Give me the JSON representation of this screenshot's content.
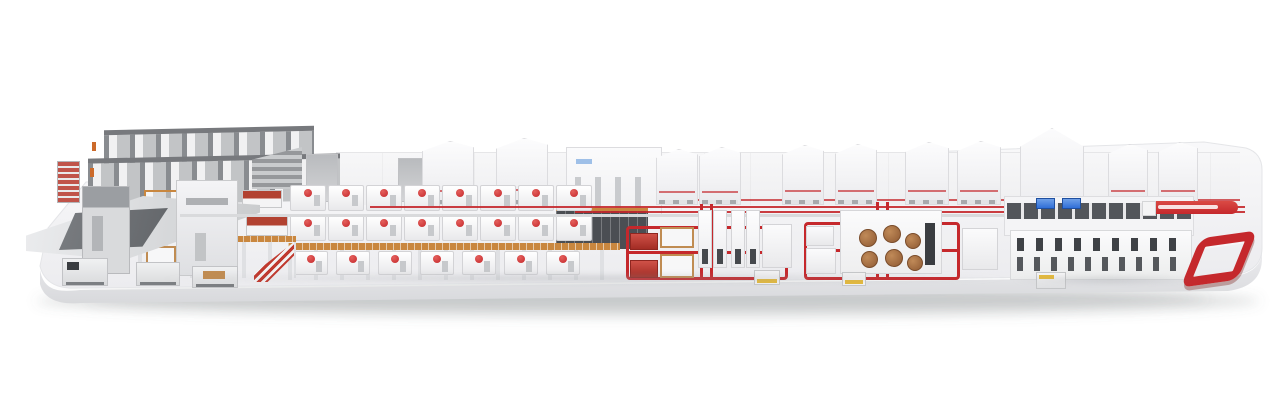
{
  "image": {
    "kind": "3d-render",
    "subject": "Complete corrugated board production line displayed on a long rounded white platform",
    "background": "white, no visible text or UI controls"
  },
  "colors": {
    "background": "#ffffff",
    "platform_top": "#f6f6f8",
    "platform_top_deep": "#ededf0",
    "platform_face": "#e5e6e9",
    "platform_face_deep": "#d6d7da",
    "machine_white": "#f9f9fa",
    "machine_edge": "#d8d9dc",
    "accent_red": "#c5282c",
    "loop_red": "#c5282c",
    "dark_red": "#a33226",
    "charcoal": "#4b4e53",
    "steel_gray": "#9b9ea2",
    "light_gray": "#d9dadc",
    "scaffold_orange": "#c9873f",
    "wood_tan": "#c08c52",
    "roll_brown": "#a06a3e",
    "screen_blue": "#2f6fd8",
    "agv_yellow": "#e3b93d"
  },
  "sections": [
    {
      "name": "roll-storage-racks",
      "description": "stepped gray storage racks with orange markers, far left background"
    },
    {
      "name": "reel-handling-area",
      "description": "flat gray splicing table with dark ramp and AGV carts on the floor"
    },
    {
      "name": "wet-end-mezzanine",
      "description": "orange scaffold mezzanine with brown paper rolls, red-topped splicers and a red-striped staircase"
    },
    {
      "name": "corrugator-bridge",
      "description": "long double-deck row of white machine modules with red motors on slim columns"
    },
    {
      "name": "dry-end-hoods",
      "description": "row of large white hood cabinets with thin red stripes along the back wall"
    },
    {
      "name": "converting-islands",
      "description": "two machine island groups surrounded by red floor conveyor loops"
    },
    {
      "name": "logistics-machine",
      "description": "long white machine with dark window rows and two blue control screens"
    },
    {
      "name": "takeoff-conveyors",
      "description": "elevated red conveyor bar and red racetrack loop at the far right"
    },
    {
      "name": "display-platform",
      "description": "rounded white slab platform with soft drop shadow"
    }
  ]
}
